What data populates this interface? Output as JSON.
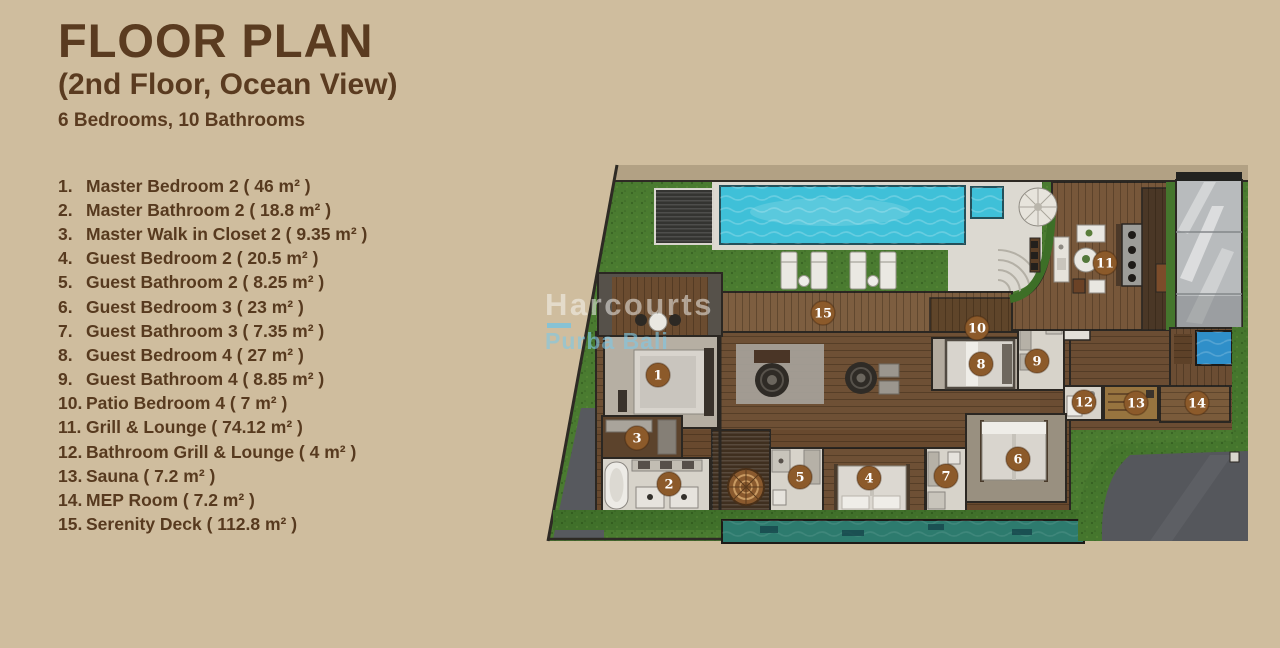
{
  "header": {
    "title": "FLOOR PLAN",
    "subtitle": "(2nd Floor, Ocean View)",
    "summary": "6 Bedrooms, 10 Bathrooms"
  },
  "legend": {
    "items": [
      {
        "num": "1.",
        "text": "Master Bedroom 2 ( 46 m² )"
      },
      {
        "num": "2.",
        "text": "Master Bathroom 2 ( 18.8 m² )"
      },
      {
        "num": "3.",
        "text": "Master Walk in Closet 2 ( 9.35 m² )"
      },
      {
        "num": "4.",
        "text": "Guest Bedroom 2 ( 20.5 m² )"
      },
      {
        "num": "5.",
        "text": "Guest Bathroom 2 ( 8.25 m² )"
      },
      {
        "num": "6.",
        "text": "Guest Bedroom 3 ( 23 m² )"
      },
      {
        "num": "7.",
        "text": "Guest Bathroom 3 ( 7.35 m² )"
      },
      {
        "num": "8.",
        "text": "Guest Bedroom 4 ( 27 m² )"
      },
      {
        "num": "9.",
        "text": "Guest Bathroom 4 ( 8.85 m² )"
      },
      {
        "num": "10.",
        "text": "Patio Bedroom 4 ( 7 m² )"
      },
      {
        "num": "11.",
        "text": "Grill & Lounge ( 74.12 m² )"
      },
      {
        "num": "12.",
        "text": "Bathroom Grill & Lounge ( 4 m² )"
      },
      {
        "num": "13.",
        "text": "Sauna ( 7.2 m² )"
      },
      {
        "num": "14.",
        "text": "MEP Room ( 7.2 m² )"
      },
      {
        "num": "15.",
        "text": "Serenity Deck ( 112.8 m² )"
      }
    ]
  },
  "watermark": {
    "brand": "Harcourts",
    "location": "Purba Bali"
  },
  "floor_plan": {
    "type": "top-down villa floor plan rendering",
    "markers": [
      {
        "n": "1",
        "x": 658,
        "y": 375
      },
      {
        "n": "2",
        "x": 669,
        "y": 484
      },
      {
        "n": "3",
        "x": 637,
        "y": 438
      },
      {
        "n": "4",
        "x": 869,
        "y": 478
      },
      {
        "n": "5",
        "x": 800,
        "y": 477
      },
      {
        "n": "6",
        "x": 1018,
        "y": 459
      },
      {
        "n": "7",
        "x": 946,
        "y": 476
      },
      {
        "n": "8",
        "x": 981,
        "y": 364
      },
      {
        "n": "9",
        "x": 1037,
        "y": 361
      },
      {
        "n": "10",
        "x": 977,
        "y": 328
      },
      {
        "n": "11",
        "x": 1105,
        "y": 263
      },
      {
        "n": "12",
        "x": 1084,
        "y": 402
      },
      {
        "n": "13",
        "x": 1136,
        "y": 403
      },
      {
        "n": "14",
        "x": 1197,
        "y": 403
      },
      {
        "n": "15",
        "x": 823,
        "y": 313
      }
    ],
    "colors": {
      "background": "#cfbd9e",
      "heading_brown": "#5a3b20",
      "marker_brown": "#8c5a2a",
      "pool_blue": "#3fc0d8",
      "lap_pool_teal": "#2d7b6e",
      "grass_green": "#4a7b30",
      "wood_deck": "#6e5035",
      "driveway_gray": "#55575c",
      "watermark_blue": "#7dc3dc"
    }
  }
}
